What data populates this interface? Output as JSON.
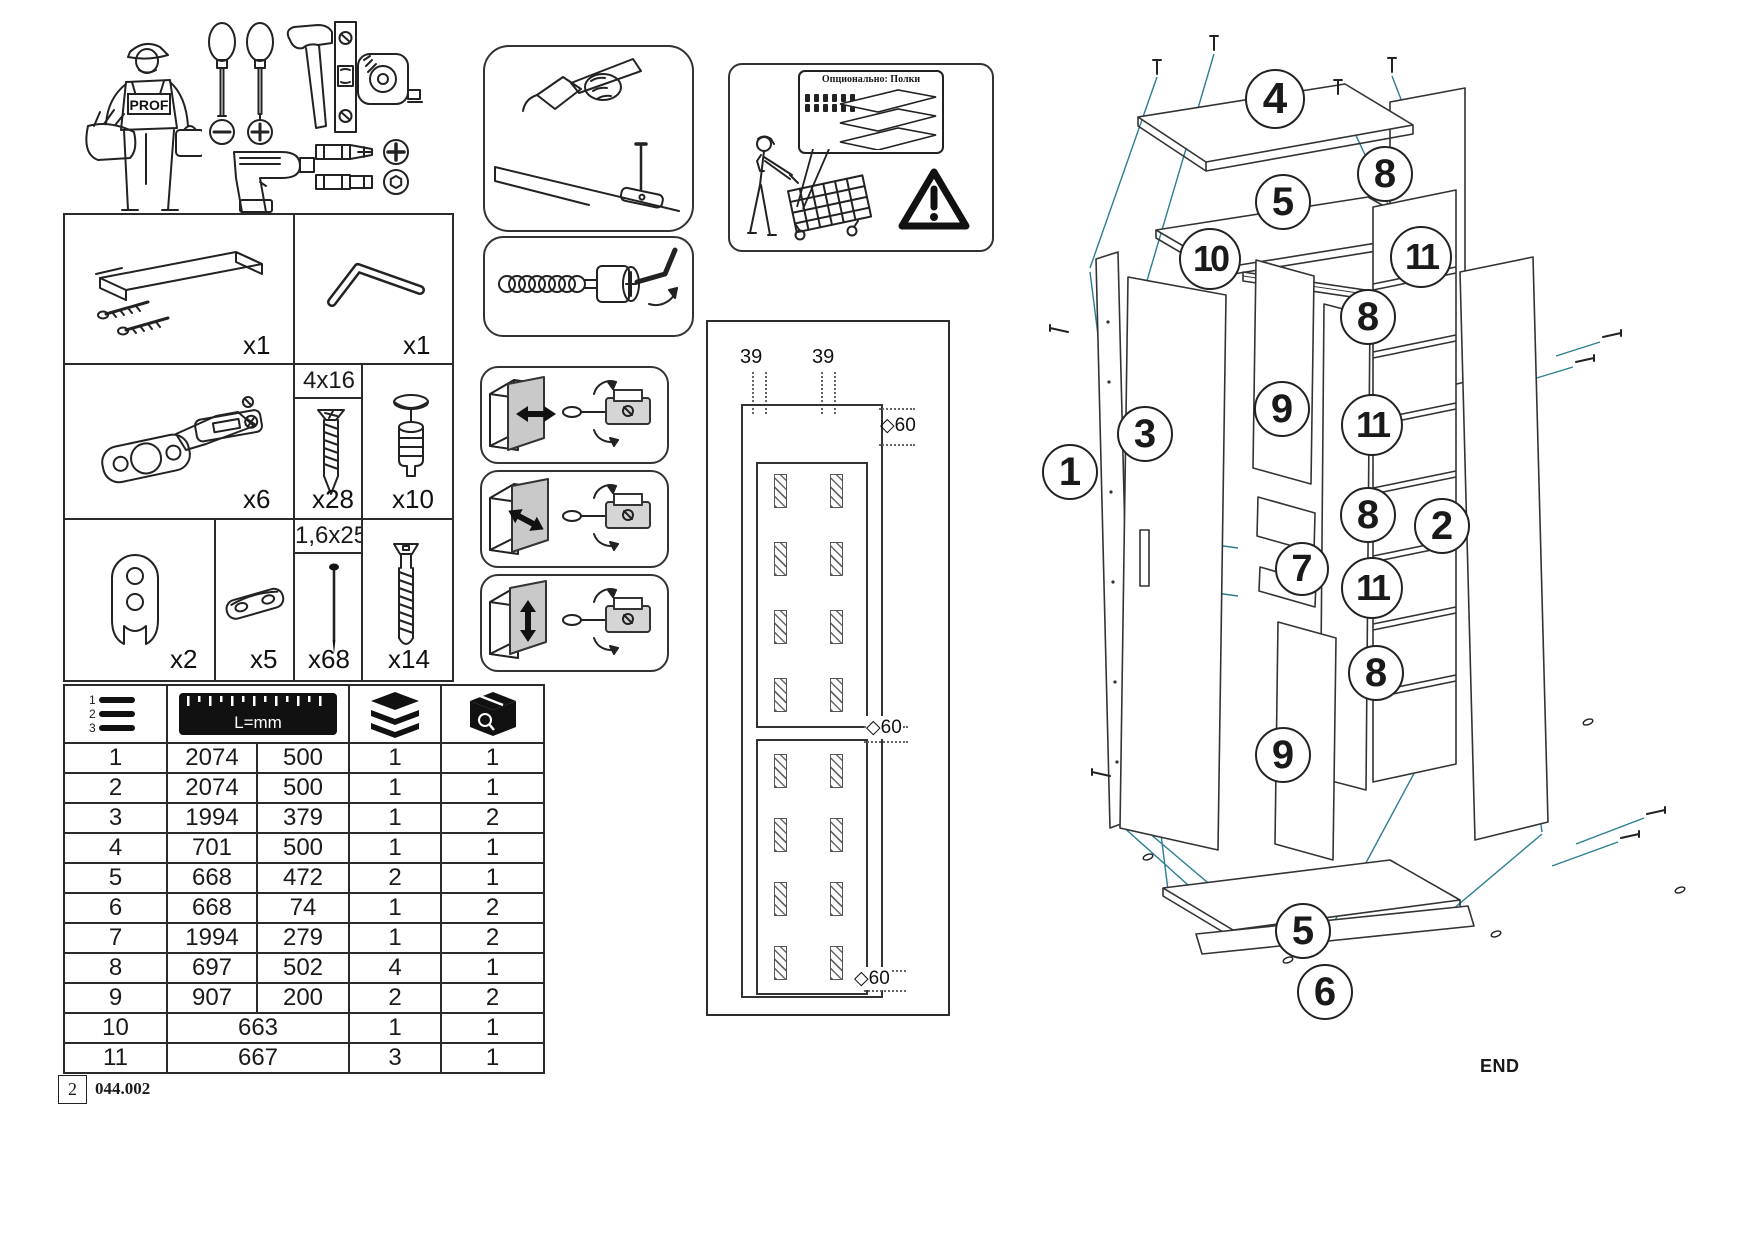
{
  "page": {
    "number": "2",
    "doc_code": "044.002",
    "end_label": "END"
  },
  "worker": {
    "vest_label": "PROF"
  },
  "parts": {
    "handle_qty": "x1",
    "allen_key_qty": "x1",
    "hinge_qty": "x6",
    "screw_size": "4x16",
    "screw_qty": "x28",
    "cam_qty": "x10",
    "hanger_qty": "x2",
    "clip_qty": "x5",
    "nail_size": "1,6x25",
    "nail_qty": "x68",
    "confirmat_qty": "x14"
  },
  "parts_table": {
    "header": {
      "n1": "1",
      "n2": "2",
      "n3": "3",
      "ruler_label": "L=mm"
    },
    "rows": [
      {
        "no": "1",
        "l": "2074",
        "w": "500",
        "layers": "1",
        "pack": "1"
      },
      {
        "no": "2",
        "l": "2074",
        "w": "500",
        "layers": "1",
        "pack": "1"
      },
      {
        "no": "3",
        "l": "1994",
        "w": "379",
        "layers": "1",
        "pack": "2"
      },
      {
        "no": "4",
        "l": "701",
        "w": "500",
        "layers": "1",
        "pack": "1"
      },
      {
        "no": "5",
        "l": "668",
        "w": "472",
        "layers": "2",
        "pack": "1"
      },
      {
        "no": "6",
        "l": "668",
        "w": "74",
        "layers": "1",
        "pack": "2"
      },
      {
        "no": "7",
        "l": "1994",
        "w": "279",
        "layers": "1",
        "pack": "2"
      },
      {
        "no": "8",
        "l": "697",
        "w": "502",
        "layers": "4",
        "pack": "1"
      },
      {
        "no": "9",
        "l": "907",
        "w": "200",
        "layers": "2",
        "pack": "2"
      },
      {
        "no": "10",
        "l": "663",
        "w": "",
        "layers": "1",
        "pack": "1"
      },
      {
        "no": "11",
        "l": "667",
        "w": "",
        "layers": "3",
        "pack": "1"
      }
    ]
  },
  "optional_box": {
    "title": "Опционально: Полки"
  },
  "drill_diagram": {
    "dim_left": "39",
    "dim_right": "39",
    "dim_symbol": "◇",
    "dim_top": "60",
    "dim_mid": "60",
    "dim_bottom": "60"
  },
  "exploded": {
    "line_color": "#2b7e92",
    "callouts": [
      "4",
      "8",
      "5",
      "10",
      "11",
      "8",
      "9",
      "3",
      "11",
      "1",
      "8",
      "2",
      "7",
      "11",
      "8",
      "9",
      "5",
      "6"
    ]
  }
}
